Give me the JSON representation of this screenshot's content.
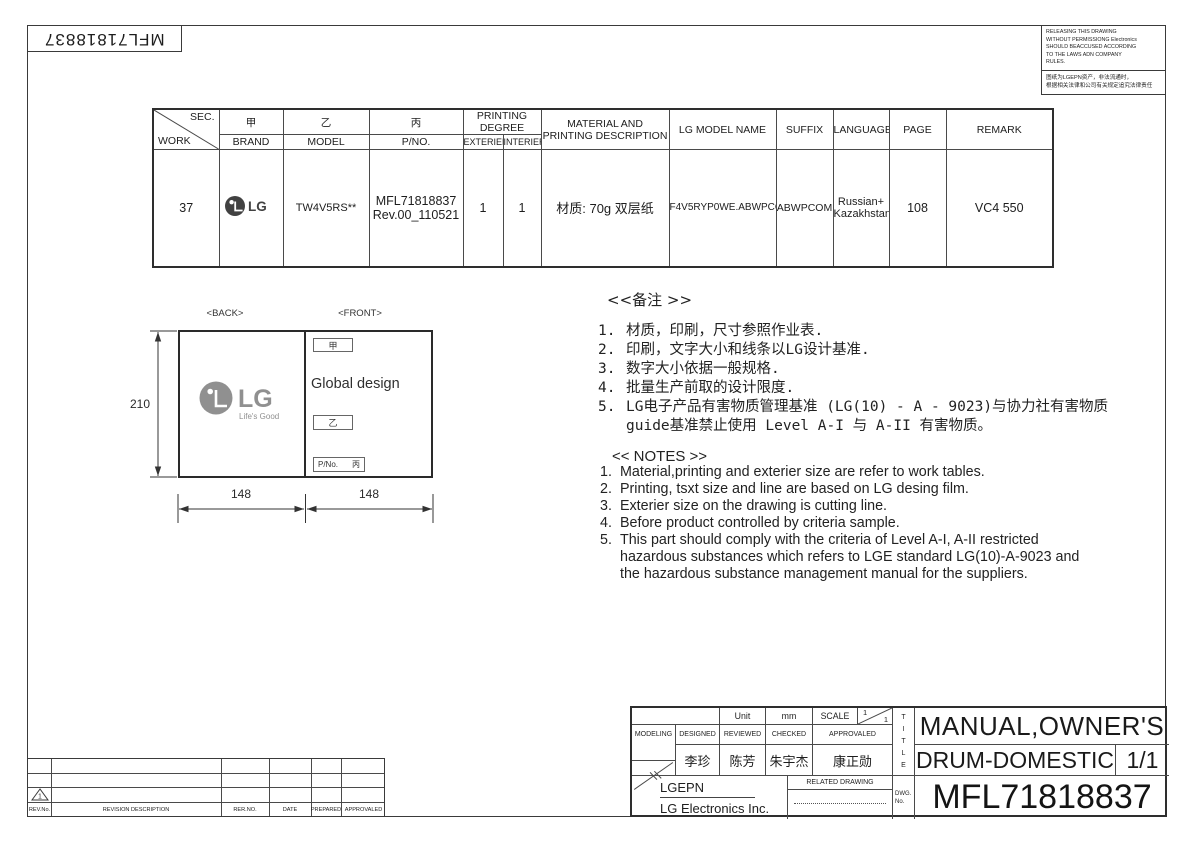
{
  "page": {
    "doc_no_mirrored": "MFL71818837",
    "warning_en": "RELEASING THIS DRAWING\nWITHOUT PERMISSIONG Electronics\nSHOULD BEACCUSED ACCORDING\nTO THE LAWS ADN COMPANY\nRULES.",
    "warning_cn": "图纸为LGEPN资产，非法流通时，\n根据相关法律和公司有关规定追究法律责任"
  },
  "work_table": {
    "header": {
      "sec": "SEC.",
      "work": "WORK",
      "jia": "甲",
      "brand": "BRAND",
      "yi": "乙",
      "model": "MODEL",
      "bing": "丙",
      "pno": "P/NO.",
      "printing_degree": "PRINTING DEGREE",
      "exterier": "EXTERIER",
      "interier": "INTERIER",
      "material": "MATERIAL AND PRINTING DESCRIPTION",
      "lg_model_name": "LG MODEL NAME",
      "suffix": "SUFFIX",
      "language": "LANGUAGE",
      "page": "PAGE",
      "remark": "REMARK"
    },
    "row": {
      "work": "37",
      "brand": "LG",
      "model": "TW4V5RS**",
      "pno": "MFL71818837\nRev.00_110521",
      "exterier": "1",
      "interier": "1",
      "material": "材质: 70g 双层纸",
      "lg_model_name": "F4V5RYP0WE.ABWPCOM",
      "suffix": "ABWPCOM",
      "language": "Russian+\nKazakhstan",
      "page": "108",
      "remark": "VC4 550"
    }
  },
  "diagram": {
    "back_label": "<BACK>",
    "front_label": "<FRONT>",
    "logo_text": "LG",
    "logo_tagline": "Life's Good",
    "box_jia": "甲",
    "global_design": "Global design",
    "box_yi": "乙",
    "pno_label": "P/No.",
    "pno_bing": "丙",
    "dim_height": "210",
    "dim_width_left": "148",
    "dim_width_right": "148"
  },
  "notes_cn": {
    "title": "<<备注 >>",
    "items": [
      {
        "n": "1.",
        "text": "材质，印刷，尺寸参照作业表."
      },
      {
        "n": "2.",
        "text": "印刷，文字大小和线条以LG设计基准."
      },
      {
        "n": "3.",
        "text": "数字大小依据一般规格."
      },
      {
        "n": "4.",
        "text": "批量生产前取的设计限度."
      },
      {
        "n": "5.",
        "text": "LG电子产品有害物质管理基准 (LG(10) - A - 9023)与协力社有害物质\nguide基准禁止使用 Level A-I 与 A-II 有害物质。"
      }
    ]
  },
  "notes_en": {
    "title": "<< NOTES >>",
    "items": [
      {
        "n": "1.",
        "text": "Material,printing and exterier size are refer to work tables."
      },
      {
        "n": "2.",
        "text": "Printing, tsxt  size and line are based on LG desing film."
      },
      {
        "n": "3.",
        "text": "Exterier size on the drawing is cutting line."
      },
      {
        "n": "4.",
        "text": "Before product controlled by criteria sample."
      },
      {
        "n": "5.",
        "text": "This part should comply with the criteria of Level A-I, A-II restricted\nhazardous substances which refers to LGE standard LG(10)-A-9023 and\nthe hazardous substance management manual for the suppliers."
      }
    ]
  },
  "title_block": {
    "unit_label": "Unit",
    "unit_value": "mm",
    "scale_label": "SCALE",
    "scale_num": "1",
    "scale_den": "1",
    "modeling": "MODELING",
    "designed": "DESIGNED",
    "reviewed": "REVIEWED",
    "checked": "CHECKED",
    "approvaled": "APPROVALED",
    "designed_name": "李珍",
    "reviewed_name": "陈芳",
    "checked_name": "朱宇杰",
    "approvaled_name": "康正勋",
    "company_short": "LGEPN",
    "company_full": "LG Electronics Inc.",
    "related_drawing": "RELATED DRAWING",
    "title_vertical": "T\nI\nT\nL\nE",
    "dwg_label": "DWG.\nNo.",
    "title_line1": "MANUAL,OWNER'S",
    "title_line2": "DRUM-DOMESTIC",
    "sheet": "1/1",
    "dwg_no": "MFL71818837"
  },
  "revision_table": {
    "rev_no": "REV.No.",
    "description": "REVISION DESCRIPTION",
    "rer_no": "RER.NO.",
    "date": "DATE",
    "prepared": "PREPARED",
    "approvaled": "APPROVALED",
    "marker": "1"
  }
}
